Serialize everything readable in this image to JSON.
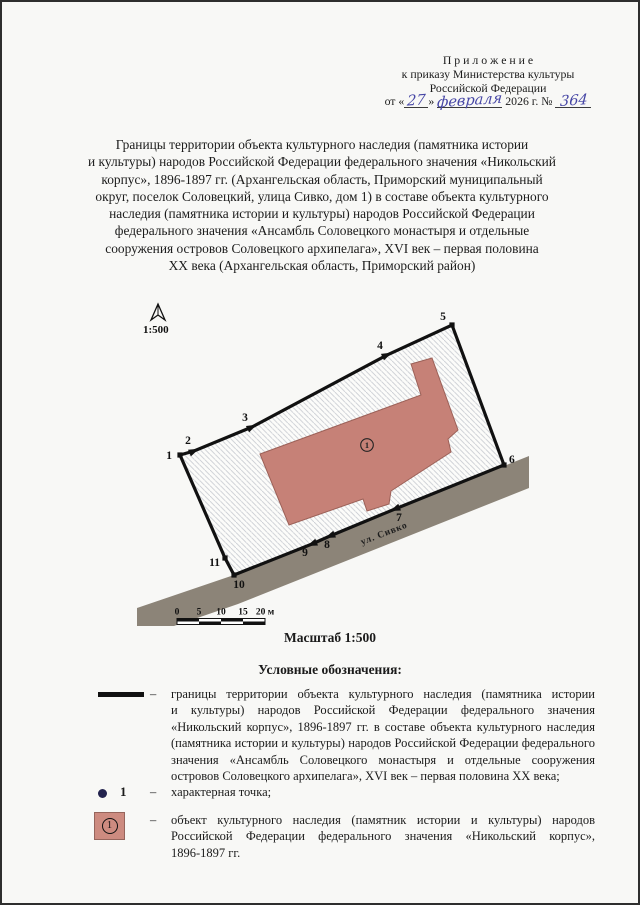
{
  "header": {
    "line1": "П р и л о ж е н и е",
    "line2": "к приказу Министерства культуры",
    "line3": "Российской Федерации",
    "date_prefix": "от «",
    "day": "27",
    "date_mid": "»",
    "month": "февраля",
    "year_suffix": "2026 г. №",
    "number": "364"
  },
  "title": {
    "lines": [
      "Границы территории объекта культурного наследия (памятника истории",
      "и культуры) народов Российской Федерации федерального значения «Никольский",
      "корпус», 1896-1897 гг. (Архангельская область, Приморский муниципальный",
      "округ, поселок Соловецкий, улица Сивко, дом 1) в составе объекта культурного",
      "наследия (памятника истории и культуры) народов Российской Федерации",
      "федерального значения «Ансамбль Соловецкого монастыря и отдельные",
      "сооружения островов Соловецкого архипелага», XVI век – первая половина",
      "XX века (Архангельская область, Приморский район)"
    ]
  },
  "map": {
    "north_label": "1:500",
    "scale_caption": "Масштаб 1:500",
    "street_label": "ул. Сивко",
    "street_label_pos": [
      383,
      534
    ],
    "street_label_angle": -21,
    "building_number": "1",
    "building_number_pos": [
      365,
      443
    ],
    "boundary_points": [
      [
        178,
        453
      ],
      [
        192,
        449
      ],
      [
        250,
        425
      ],
      [
        385,
        353
      ],
      [
        450,
        323
      ],
      [
        502,
        463
      ],
      [
        393,
        507
      ],
      [
        328,
        534
      ],
      [
        310,
        542
      ],
      [
        232,
        573
      ],
      [
        223,
        556
      ]
    ],
    "vertex_labels": [
      {
        "n": "1",
        "x": 170,
        "y": 457,
        "anchor": "end"
      },
      {
        "n": "2",
        "x": 186,
        "y": 442,
        "anchor": "middle"
      },
      {
        "n": "3",
        "x": 243,
        "y": 419,
        "anchor": "middle"
      },
      {
        "n": "4",
        "x": 378,
        "y": 347,
        "anchor": "middle"
      },
      {
        "n": "5",
        "x": 441,
        "y": 318,
        "anchor": "middle"
      },
      {
        "n": "6",
        "x": 507,
        "y": 461,
        "anchor": "start"
      },
      {
        "n": "7",
        "x": 397,
        "y": 519,
        "anchor": "middle"
      },
      {
        "n": "8",
        "x": 325,
        "y": 546,
        "anchor": "middle"
      },
      {
        "n": "9",
        "x": 303,
        "y": 554,
        "anchor": "middle"
      },
      {
        "n": "10",
        "x": 237,
        "y": 586,
        "anchor": "middle"
      },
      {
        "n": "11",
        "x": 218,
        "y": 564,
        "anchor": "end"
      }
    ],
    "markers": {
      "squares": [
        0,
        4,
        5,
        9,
        10
      ],
      "arrows": [
        {
          "i": 1,
          "angle": -24
        },
        {
          "i": 2,
          "angle": -26
        },
        {
          "i": 3,
          "angle": -25
        },
        {
          "i": 6,
          "angle": 158
        },
        {
          "i": 7,
          "angle": 158
        },
        {
          "i": 8,
          "angle": 158
        }
      ]
    },
    "building_points": [
      [
        258,
        452
      ],
      [
        419,
        393
      ],
      [
        409,
        362
      ],
      [
        430,
        356
      ],
      [
        456,
        428
      ],
      [
        446,
        437
      ],
      [
        449,
        450
      ],
      [
        389,
        489
      ],
      [
        387,
        502
      ],
      [
        365,
        509
      ],
      [
        361,
        497
      ],
      [
        287,
        523
      ]
    ],
    "street_points": [
      [
        527,
        454
      ],
      [
        502,
        464
      ],
      [
        393,
        507
      ],
      [
        328,
        534
      ],
      [
        310,
        542
      ],
      [
        232,
        573
      ],
      [
        135,
        606
      ],
      [
        135,
        624
      ],
      [
        172,
        624
      ],
      [
        236,
        602
      ],
      [
        527,
        486
      ]
    ],
    "scalebar": {
      "x": 175,
      "y": 616.5,
      "cell_w": 22,
      "cell_h": 3,
      "ticks": [
        "0",
        "5",
        "10",
        "15",
        "20 м"
      ]
    },
    "north_arrow": {
      "apex": [
        156,
        302
      ],
      "left": [
        149,
        318
      ],
      "notch": [
        156,
        313
      ],
      "right": [
        163,
        318
      ],
      "label_x": 141,
      "label_y": 331
    },
    "colors": {
      "building": "#c68177",
      "building_stroke": "#9c6158",
      "street": "#8c8478",
      "boundary": "#111111",
      "hatch": "#c9ccd2",
      "fill": "#fcfcfa"
    }
  },
  "legend": {
    "heading": "Условные обозначения:",
    "items": [
      {
        "dash": "–",
        "lines": [
          "границы территории объекта культурного наследия (памятника истории",
          "и культуры) народов Российской Федерации федерального значения",
          "«Никольский корпус», 1896-1897 гг. в составе объекта культурного наследия",
          "(памятника истории и культуры) народов Российской Федерации федерального",
          "значения «Ансамбль Соловецкого монастыря и отдельные сооружения",
          "островов Соловецкого архипелага», XVI век – первая половина XX века;"
        ]
      },
      {
        "dash": "–",
        "num": "1",
        "text": "характерная точка;"
      },
      {
        "dash": "–",
        "num": "1",
        "lines": [
          "объект культурного наследия (памятник истории и культуры) народов",
          "Российской Федерации федерального значения «Никольский корпус»,",
          "1896-1897 гг."
        ]
      }
    ]
  }
}
